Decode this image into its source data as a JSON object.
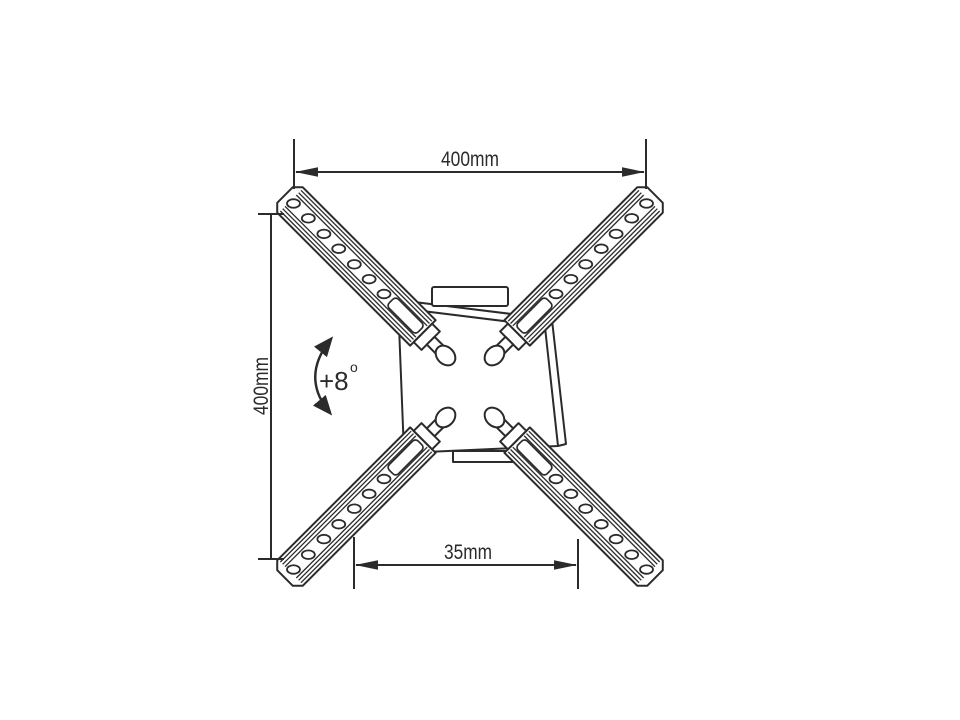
{
  "diagram": {
    "subject": "tv-wall-mount-bracket-rear-view",
    "colors": {
      "line": "#2b2b2b",
      "background": "#ffffff"
    },
    "dimensions": {
      "top_width": {
        "label": "400mm"
      },
      "left_height": {
        "label": "400mm"
      },
      "bottom_spacing": {
        "label": "35mm"
      }
    },
    "angle": {
      "label": "+8",
      "degree_symbol": "o"
    },
    "parts": {
      "plate": "mount-plate",
      "arms": [
        "arm-upper-left",
        "arm-upper-right",
        "arm-lower-left",
        "arm-lower-right"
      ]
    }
  }
}
